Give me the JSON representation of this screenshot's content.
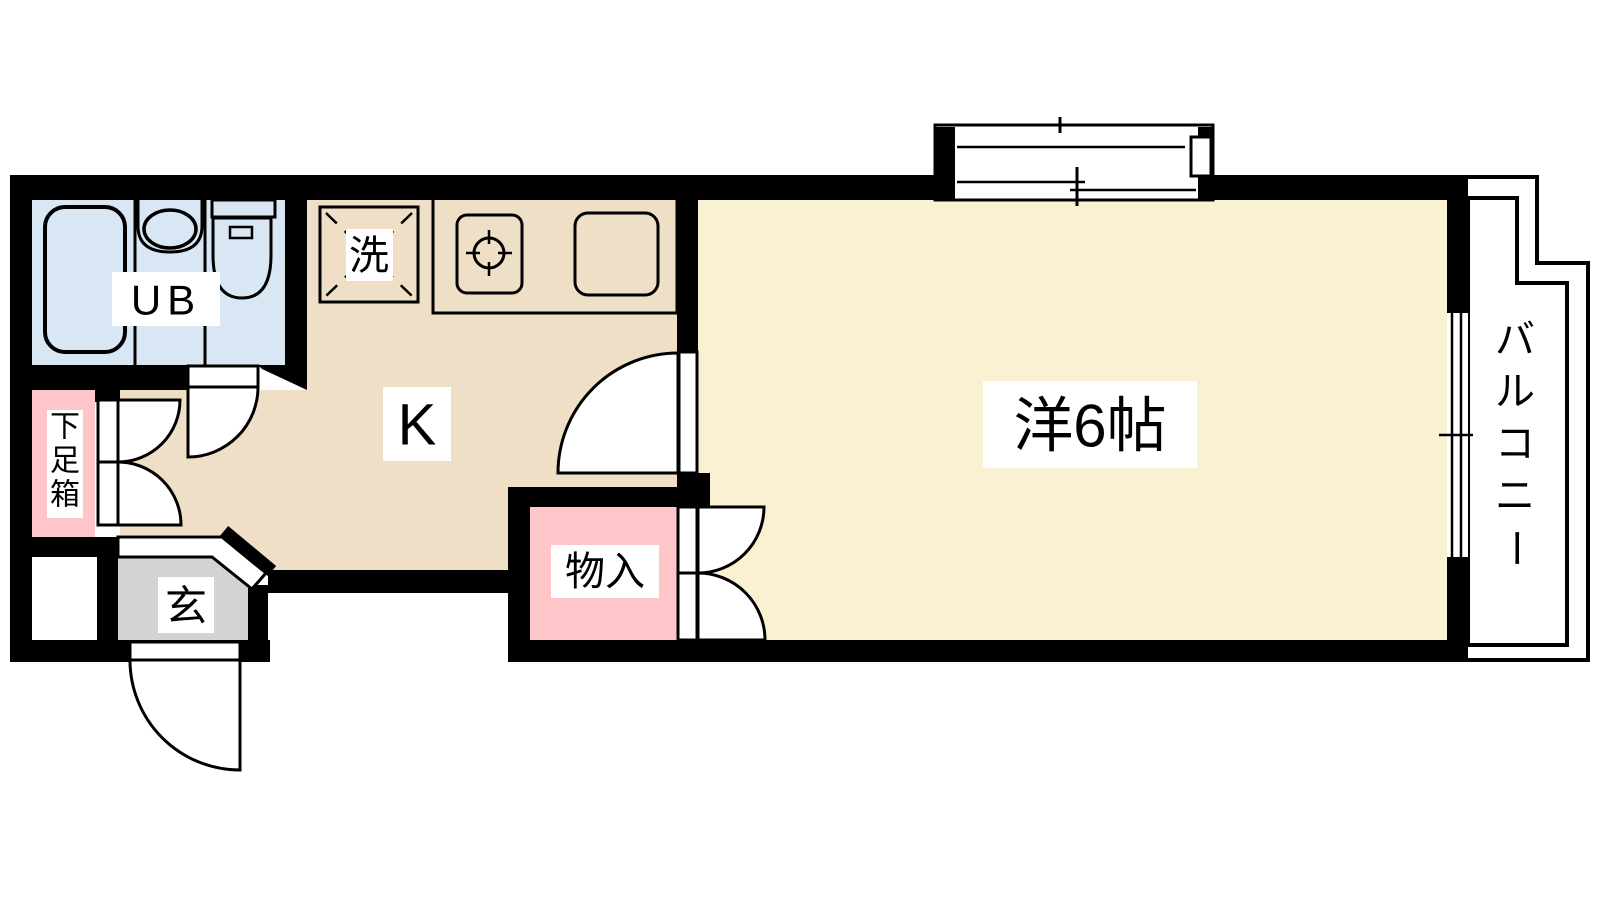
{
  "doc": {
    "title": "1K apartment floor plan"
  },
  "colors": {
    "wall": "#000000",
    "bath_floor": "#d9e7f5",
    "kitchen_floor": "#efdfc6",
    "room_floor": "#faf0d2",
    "cabinet_pink": "#ffc6ca",
    "entrance_gray": "#d3d3d3",
    "white": "#ffffff"
  },
  "labels": {
    "unit_bath": "UB",
    "washer": "洗",
    "kitchen": "K",
    "western_room": "洋6帖",
    "storage": "物入",
    "entrance": "玄",
    "shoe_cabinet_chars": [
      "下",
      "足",
      "箱"
    ],
    "balcony_chars": [
      "バ",
      "ル",
      "コ",
      "ニ",
      "ー"
    ]
  }
}
